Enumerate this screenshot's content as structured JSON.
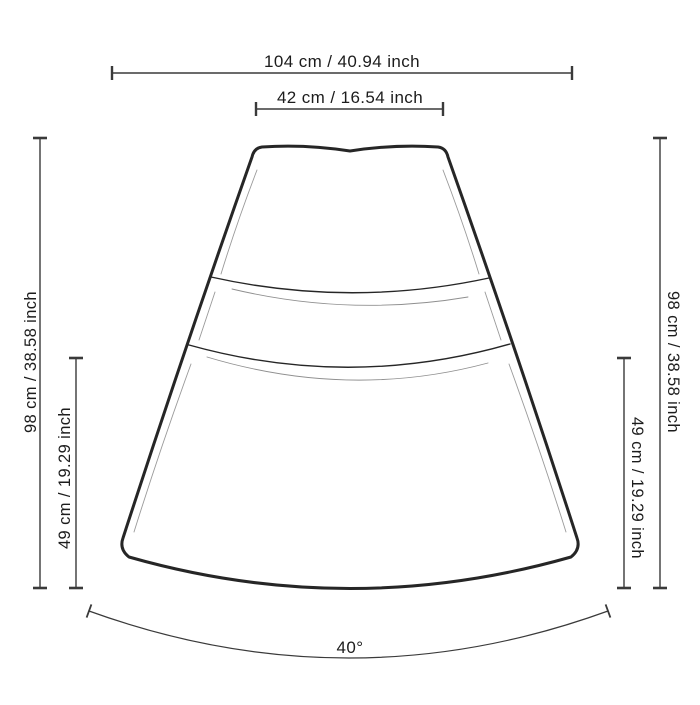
{
  "page": {
    "background": "#ffffff"
  },
  "dimensions": {
    "overall_width": "104 cm / 40.94 inch",
    "top_width": "42 cm / 16.54 inch",
    "overall_height_left": "98 cm / 38.58 inch",
    "partial_height_left": "49 cm / 19.29 inch",
    "overall_height_right": "98 cm / 38.58 inch",
    "partial_height_right": "49 cm / 19.29 inch",
    "arc_angle": "40°"
  },
  "figure": {
    "type": "technical line drawing",
    "subject": "curved wedge-shaped seat module with two horizontal seam lines",
    "colors": {
      "outline": "#262626",
      "dimension_line": "#3a3a3a",
      "secondary_line": "#8f8f8f",
      "text": "#1c1c1c",
      "background": "#ffffff"
    }
  }
}
